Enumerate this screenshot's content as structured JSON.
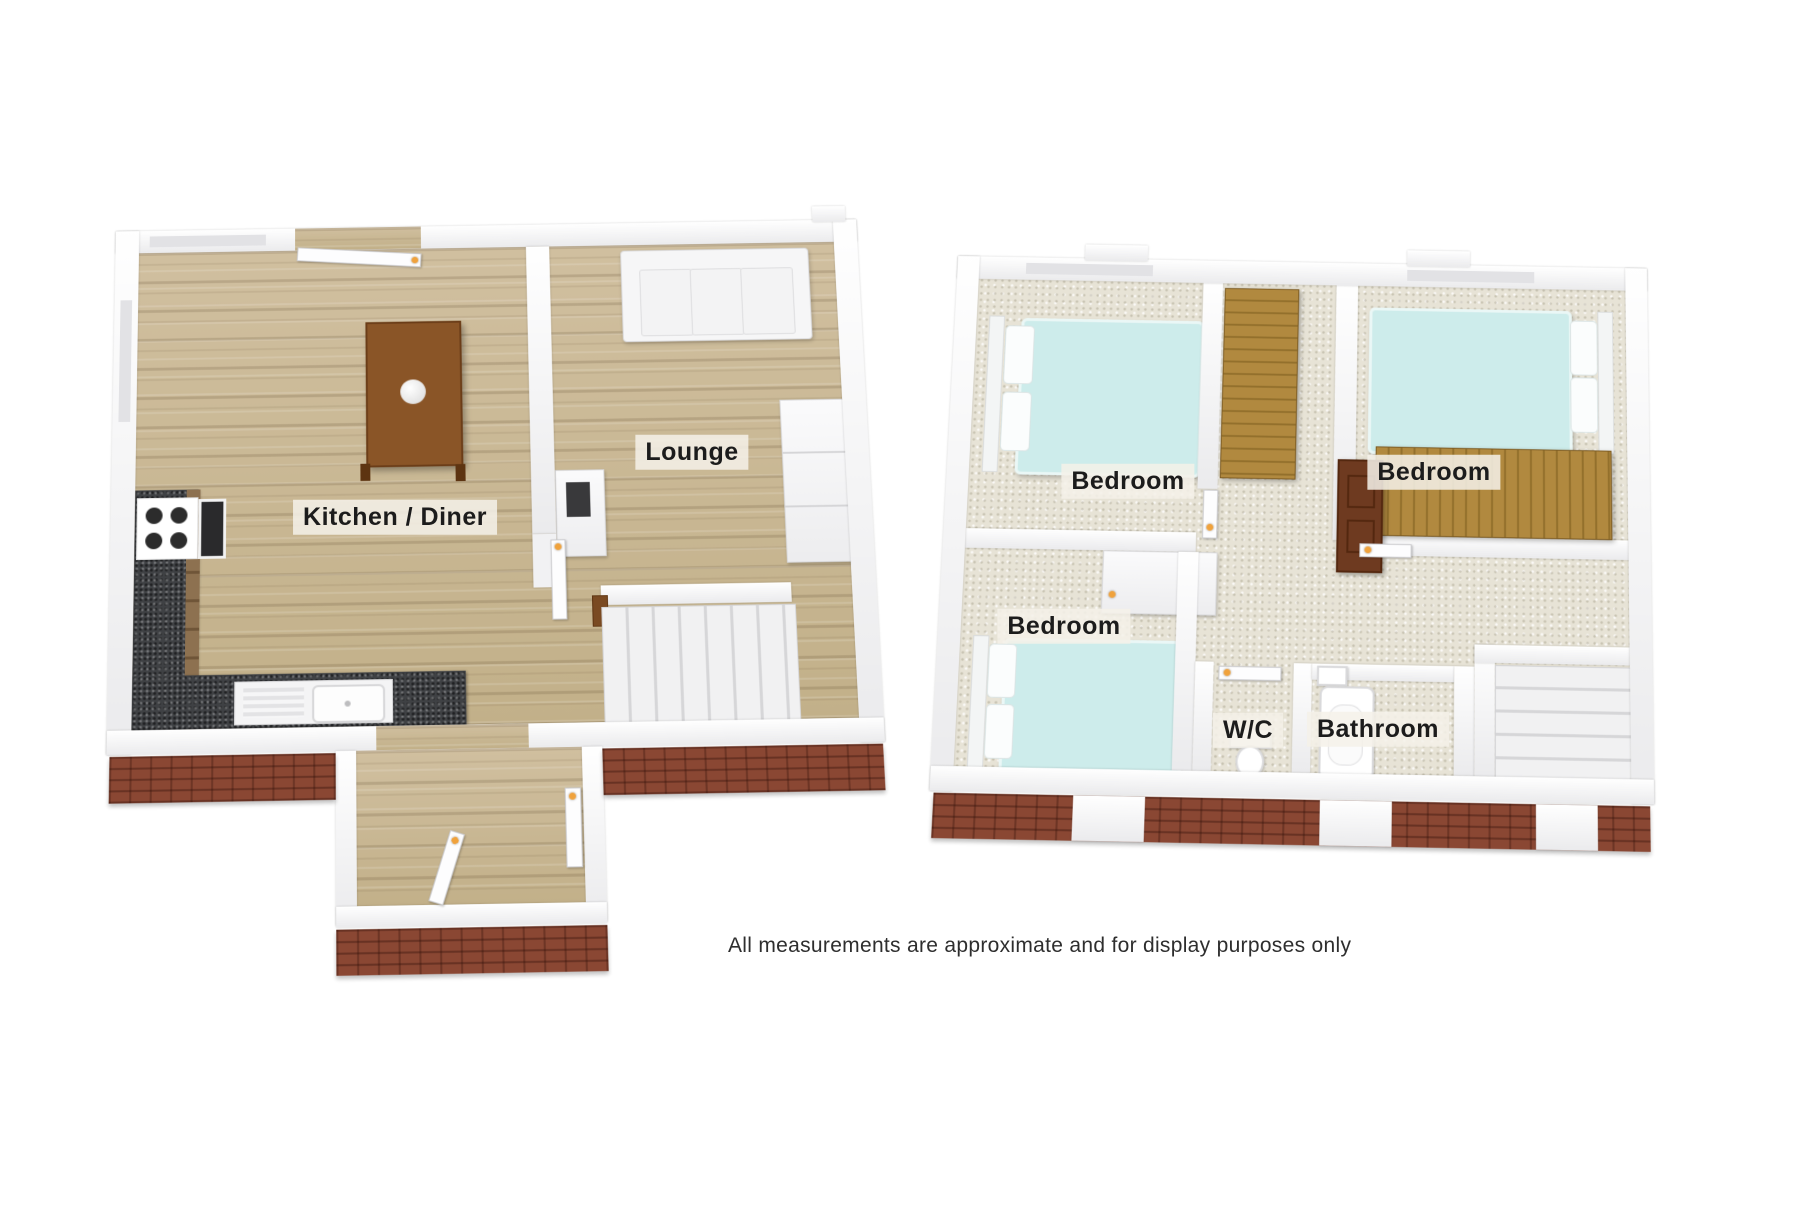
{
  "ground_floor": {
    "room_labels": [
      {
        "id": "kitchen-diner",
        "text": "Kitchen / Diner"
      },
      {
        "id": "lounge",
        "text": "Lounge"
      }
    ],
    "furniture_icons": [
      "entrance-door",
      "dining-table",
      "fruit-bowl",
      "kitchen-counter",
      "hob",
      "oven",
      "kitchen-sink",
      "sofa",
      "media-unit",
      "fireplace",
      "stairs",
      "interior-door",
      "porch"
    ]
  },
  "first_floor": {
    "room_labels": [
      {
        "id": "bedroom-top-left",
        "text": "Bedroom"
      },
      {
        "id": "bedroom-top-right",
        "text": "Bedroom"
      },
      {
        "id": "bedroom-bottom-left",
        "text": "Bedroom"
      },
      {
        "id": "wc",
        "text": "W/C"
      },
      {
        "id": "bathroom",
        "text": "Bathroom"
      }
    ],
    "furniture_icons": [
      "double-bed",
      "double-bed",
      "double-bed",
      "wardrobe",
      "wardrobe",
      "dresser",
      "closet",
      "toilet",
      "bathtub",
      "bathroom-sink",
      "stairs",
      "interior-door"
    ]
  },
  "footer": {
    "disclaimer": "All measurements are approximate and for display purposes only"
  },
  "colors": {
    "background": "#ffffff",
    "wall_white": "#f7f7f8",
    "brick_base": "#8a4733",
    "wood_floor": "#cbb996",
    "carpet": "#e7e3d6",
    "granite_worktop": "#3f4144",
    "bed_duvet": "#cdeceb",
    "wardrobe_wood": "#b1893f",
    "table_wood": "#8a5527",
    "door_handle": "#f0a23c",
    "label_text": "#1c1c1c",
    "label_background": "#f4f1e9",
    "disclaimer_text": "#2e2e2e"
  }
}
